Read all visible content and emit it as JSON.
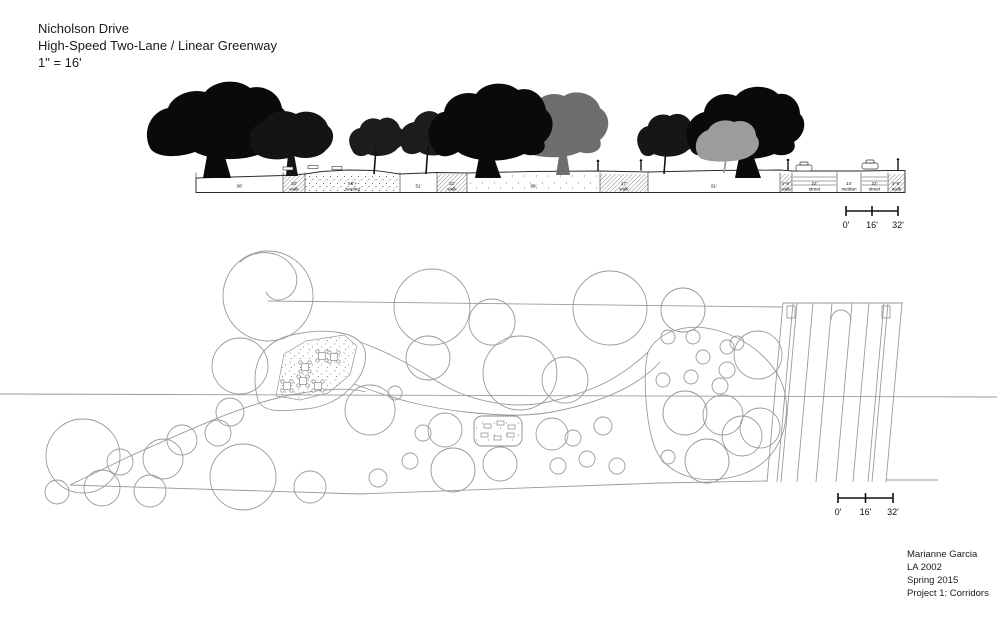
{
  "title": {
    "line1": "Nicholson Drive",
    "line2": "High-Speed Two-Lane / Linear Greenway",
    "line3": "1\" = 16'"
  },
  "credits": {
    "line1": "Marianne Garcia",
    "line2": "LA 2002",
    "line3": "Spring 2015",
    "line4": "Project 1: Corridors"
  },
  "scale_bar": {
    "labels": [
      "0'",
      "16'",
      "32'"
    ]
  },
  "elevation": {
    "bands": [
      {
        "label": "36'",
        "x0": 196,
        "x1": 283,
        "type": "plain"
      },
      {
        "label": "10'",
        "sub": "walk",
        "x0": 283,
        "x1": 305,
        "type": "hatch"
      },
      {
        "label": "56'+",
        "sub": "seating",
        "x0": 305,
        "x1": 400,
        "type": "stipple"
      },
      {
        "label": "51'",
        "x0": 400,
        "x1": 437,
        "type": "plain"
      },
      {
        "label": "22'",
        "sub": "walk",
        "x0": 437,
        "x1": 467,
        "type": "hatch"
      },
      {
        "label": "88'",
        "x0": 467,
        "x1": 600,
        "type": "stipple-sparse"
      },
      {
        "label": "17'",
        "sub": "walk",
        "x0": 600,
        "x1": 648,
        "type": "hatch"
      },
      {
        "label": "91'",
        "x0": 648,
        "x1": 780,
        "type": "plain"
      },
      {
        "label": "4'-6\"",
        "sub": "walk",
        "x0": 780,
        "x1": 792,
        "type": "hatch"
      },
      {
        "label": "22'",
        "sub": "street",
        "x0": 792,
        "x1": 837,
        "type": "street"
      },
      {
        "label": "14'",
        "sub": "median",
        "x0": 837,
        "x1": 861,
        "type": "plain"
      },
      {
        "label": "22'",
        "sub": "street",
        "x0": 861,
        "x1": 888,
        "type": "street"
      },
      {
        "label": "4'-6\"",
        "sub": "walk",
        "x0": 888,
        "x1": 905,
        "type": "hatch"
      }
    ]
  },
  "plan": {
    "circles": [
      [
        83,
        456,
        37
      ],
      [
        120,
        462,
        13
      ],
      [
        163,
        459,
        20
      ],
      [
        102,
        488,
        18
      ],
      [
        150,
        491,
        16
      ],
      [
        57,
        492,
        12
      ],
      [
        182,
        440,
        15
      ],
      [
        230,
        412,
        14
      ],
      [
        218,
        433,
        13
      ],
      [
        243,
        477,
        33
      ],
      [
        310,
        487,
        16
      ],
      [
        268,
        296,
        45
      ],
      [
        240,
        366,
        28
      ],
      [
        370,
        410,
        25
      ],
      [
        395,
        393,
        7
      ],
      [
        432,
        307,
        38
      ],
      [
        492,
        322,
        23
      ],
      [
        428,
        358,
        22
      ],
      [
        520,
        373,
        37
      ],
      [
        565,
        380,
        23
      ],
      [
        610,
        308,
        37
      ],
      [
        683,
        310,
        22
      ],
      [
        445,
        430,
        17
      ],
      [
        423,
        433,
        8
      ],
      [
        410,
        461,
        8
      ],
      [
        453,
        470,
        22
      ],
      [
        378,
        478,
        9
      ],
      [
        500,
        464,
        17
      ],
      [
        552,
        434,
        16
      ],
      [
        573,
        438,
        8
      ],
      [
        558,
        466,
        8
      ],
      [
        587,
        459,
        8
      ],
      [
        603,
        426,
        9
      ],
      [
        617,
        466,
        8
      ],
      [
        663,
        380,
        7
      ],
      [
        691,
        377,
        7
      ],
      [
        703,
        357,
        7
      ],
      [
        727,
        347,
        7
      ],
      [
        727,
        370,
        8
      ],
      [
        720,
        386,
        8
      ],
      [
        693,
        337,
        7
      ],
      [
        737,
        343,
        7
      ],
      [
        668,
        337,
        7
      ],
      [
        758,
        355,
        24
      ],
      [
        685,
        413,
        22
      ],
      [
        723,
        415,
        20
      ],
      [
        742,
        436,
        20
      ],
      [
        707,
        461,
        22
      ],
      [
        668,
        457,
        7
      ],
      [
        760,
        428,
        20
      ]
    ],
    "picnic_tables": [
      [
        287,
        386
      ],
      [
        303,
        381
      ],
      [
        318,
        386
      ],
      [
        305,
        367
      ],
      [
        322,
        356
      ],
      [
        334,
        357
      ]
    ],
    "pod_benches": [
      [
        484,
        424
      ],
      [
        497,
        421
      ],
      [
        508,
        425
      ],
      [
        481,
        433
      ],
      [
        494,
        436
      ],
      [
        507,
        433
      ]
    ]
  },
  "colors": {
    "ink": "#1a1a1a",
    "plan_line": "#9a9a9a",
    "tree_black": "#0a0a0a",
    "tree_gray_dark": "#6e6e6e",
    "tree_gray_light": "#9c9c9c"
  }
}
